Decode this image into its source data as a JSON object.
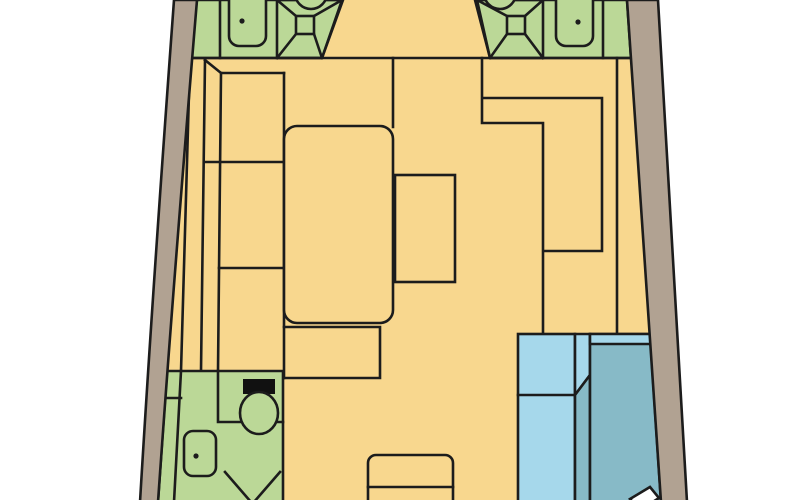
{
  "diagram": {
    "type": "boat-interior-floor-plan",
    "regions": {
      "forward_head_port": "forward head with shower pan, washbasin and toilet",
      "forward_head_starboard": "forward head with shower pan, washbasin and toilet",
      "saloon": "saloon with L-settee, large berth and table",
      "galley": "galley counter run on starboard side",
      "companionway": "companionway steps",
      "aft_head": "aft head with toilet, washbasin and shower",
      "aft_cabin": "aft cabin with teal berth, blue seat and pillow"
    }
  },
  "colors": {
    "background": "#FFFFFF",
    "floor": "#F8D78E",
    "cabin_green": "#BBD897",
    "hull": "#B1A292",
    "seat_blue": "#A6D8EB",
    "berth_teal": "#87BAC7",
    "line": "#1C1C1C",
    "toilet_tank": "#111111",
    "pillow_white": "#FFFFFF"
  }
}
